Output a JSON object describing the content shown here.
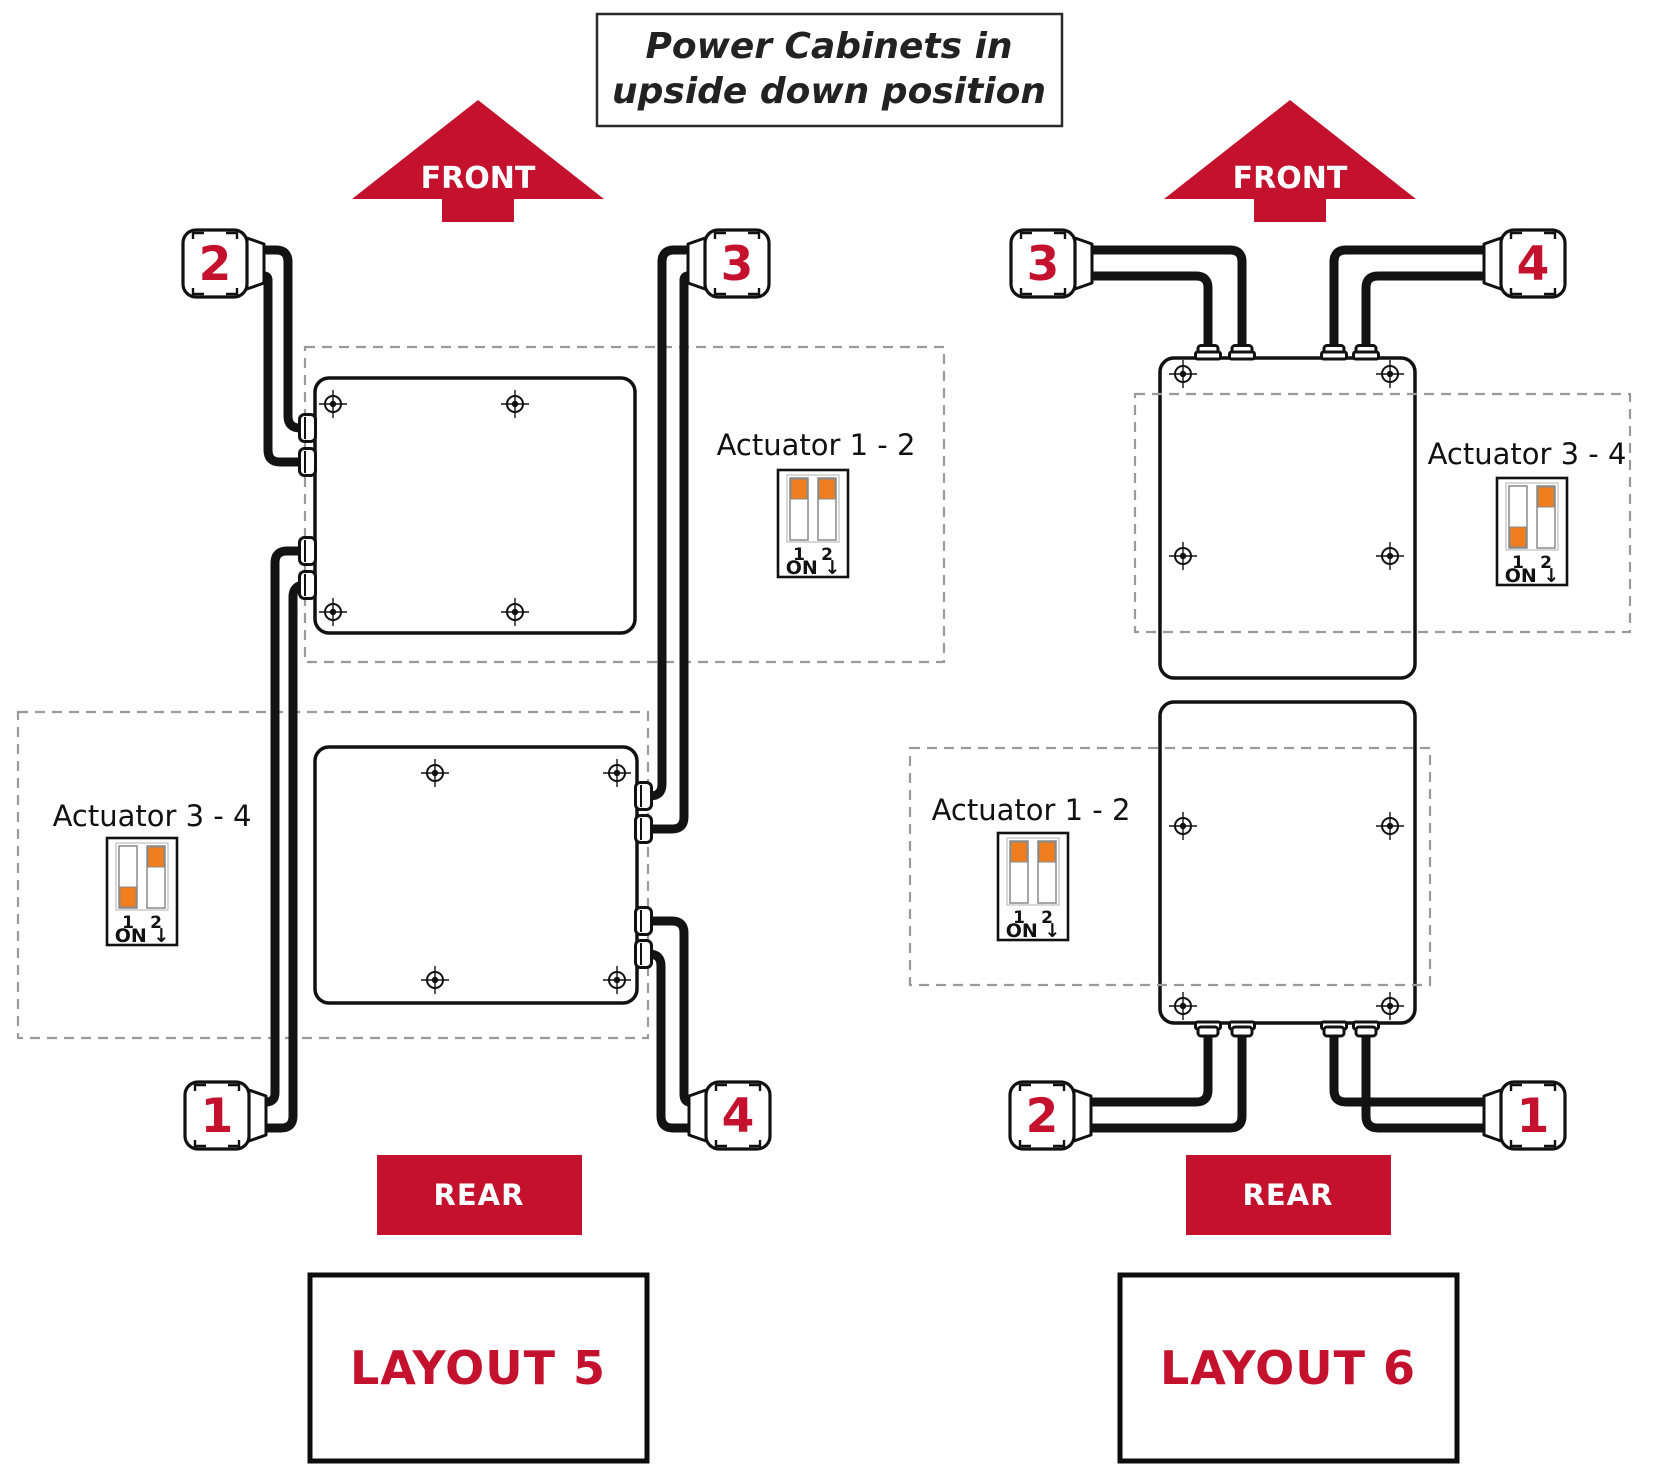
{
  "title": {
    "line1": "Power Cabinets in",
    "line2": "upside down position"
  },
  "colors": {
    "red": "#C4122E",
    "orange": "#F07D1E",
    "line": "#111111",
    "dash": "#9A9A9A"
  },
  "direction_labels": {
    "front": "FRONT",
    "rear": "REAR"
  },
  "layout5": {
    "name": "LAYOUT 5",
    "connectors": {
      "top_left": "2",
      "top_right": "3",
      "bottom_left": "1",
      "bottom_right": "4"
    },
    "dips": {
      "actuator12": {
        "label": "Actuator 1 - 2",
        "pin1": "1",
        "pin2": "2",
        "on": "ON ↓",
        "switch1": "up",
        "switch2": "up"
      },
      "actuator34": {
        "label": "Actuator 3 - 4",
        "pin1": "1",
        "pin2": "2",
        "on": "ON ↓",
        "switch1": "down",
        "switch2": "up"
      }
    }
  },
  "layout6": {
    "name": "LAYOUT 6",
    "connectors": {
      "top_left": "3",
      "top_right": "4",
      "bottom_left": "2",
      "bottom_right": "1"
    },
    "dips": {
      "actuator34": {
        "label": "Actuator 3 - 4",
        "pin1": "1",
        "pin2": "2",
        "on": "ON ↓",
        "switch1": "down",
        "switch2": "up"
      },
      "actuator12": {
        "label": "Actuator 1 - 2",
        "pin1": "1",
        "pin2": "2",
        "on": "ON ↓",
        "switch1": "up",
        "switch2": "up"
      }
    }
  }
}
